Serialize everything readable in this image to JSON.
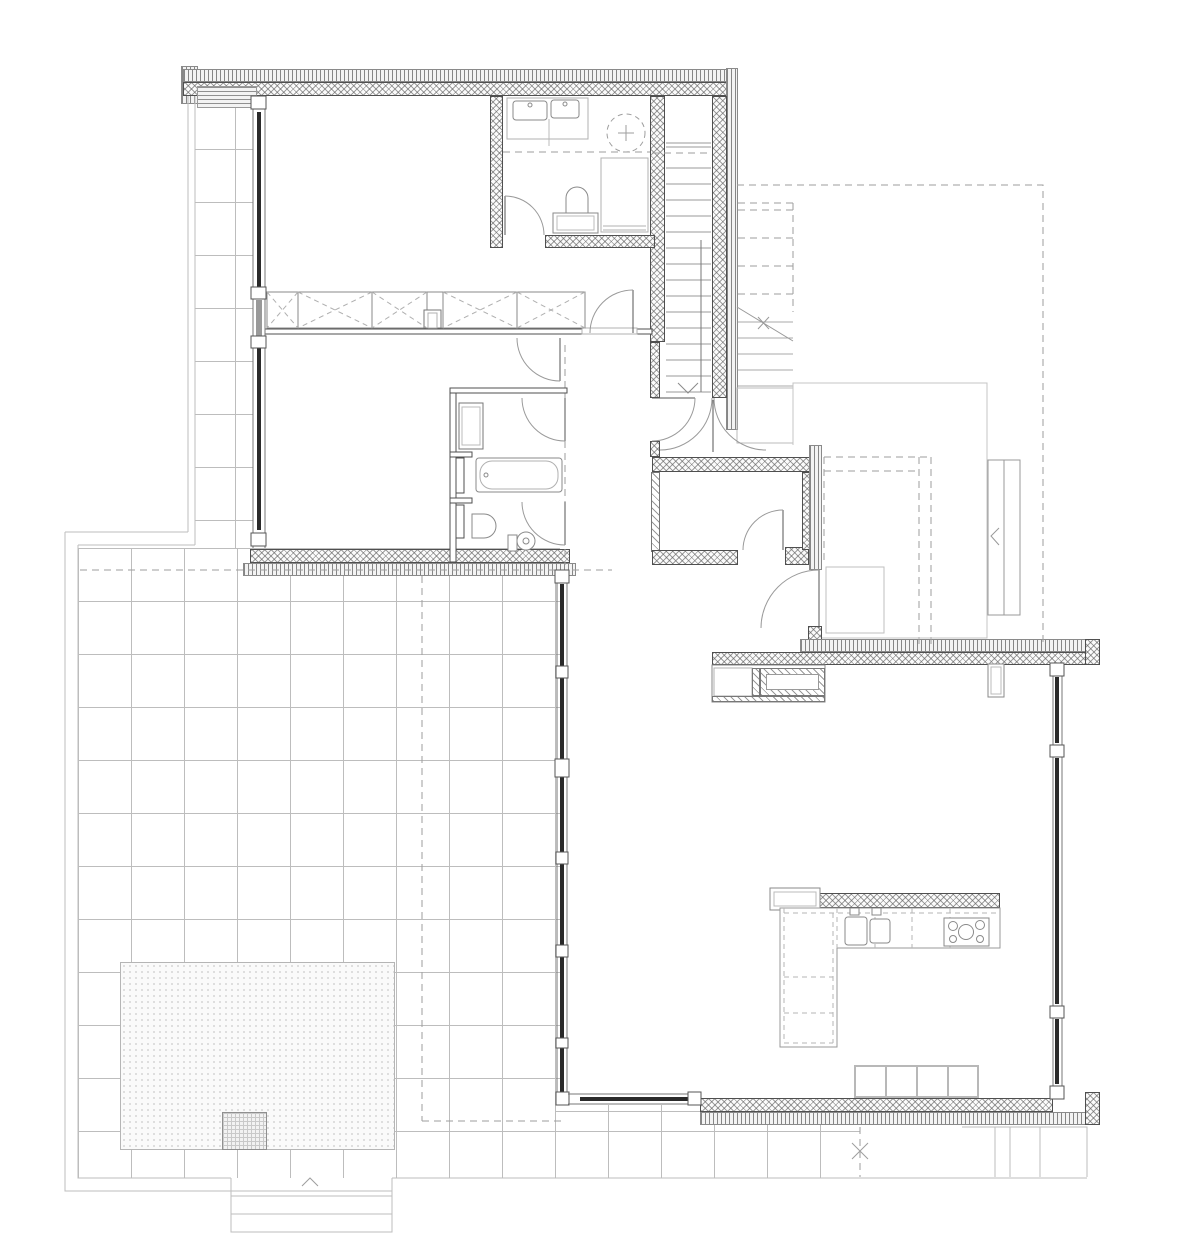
{
  "drawing": {
    "kind": "architectural-floor-plan",
    "aria_label": "Ground floor plan of a single family house with terrace",
    "canvas": {
      "width": 1200,
      "height": 1237
    },
    "tile_grid_px": 53,
    "visible_text": []
  },
  "colors": {
    "paper": "#ffffff",
    "line_dark": "#4f4f4f",
    "line_mid": "#8a8a8a",
    "line_light": "#bdbdbd",
    "dashed": "#9e9e9e",
    "glass": "#2a2a2a",
    "fixture": "#8a8a8a",
    "furniture": "#b5b5b5"
  },
  "elements": {
    "rooms": [
      "bedroom-1",
      "dressing-corridor",
      "bathroom",
      "bedroom-2",
      "ensuite-bathroom",
      "hallway",
      "staircase",
      "storeroom",
      "entry-hall",
      "living-dining-room",
      "kitchen",
      "terrace"
    ],
    "fixtures": [
      "double-washbasin",
      "skylight",
      "shower",
      "toilet",
      "wardrobe-row",
      "built-in-closet",
      "bathtub",
      "ensuite-toilet",
      "floor-drain",
      "fireplace",
      "radiator",
      "kitchen-counter",
      "kitchen-sink",
      "cooktop",
      "bench",
      "sandpit",
      "garden-steps"
    ],
    "annotations": [
      "roof-overhang-dashed",
      "exterior-stair",
      "stair-direction-arrow",
      "entrance-mat",
      "privacy-screen",
      "terrace-pad"
    ]
  },
  "patterns": {
    "exterior_wall": "crosshatch-insulation",
    "cladding": "vertical-line-hatch",
    "interior_heavy_wall": "diagonal-hatch",
    "terrace": "tile-grid",
    "planting_bed": "dot-stipple"
  }
}
